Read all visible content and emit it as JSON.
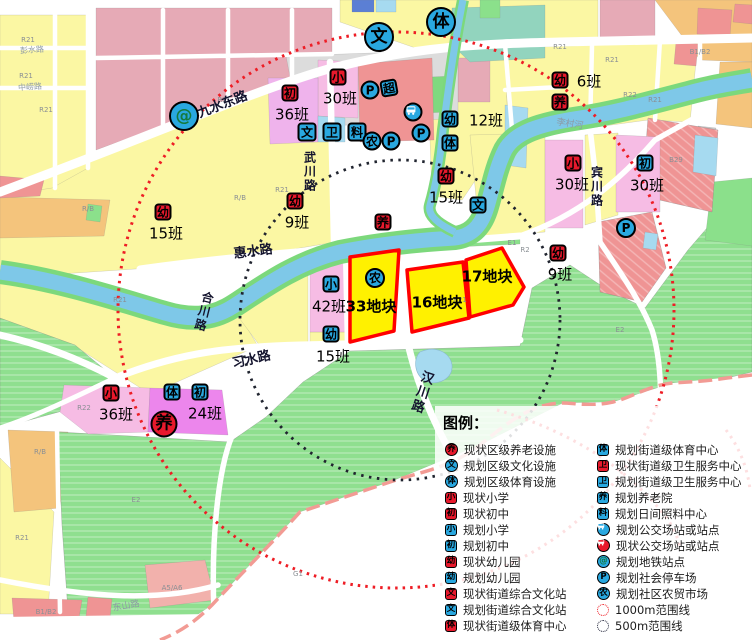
{
  "colors": {
    "icon_red": "#E8192C",
    "icon_blue": "#29A8E0",
    "metro_glyph": "#157A3E",
    "site_fill": "#FFF100",
    "site_border": "#FF0000",
    "range_1000": "#EE1D25",
    "range_500": "#23263B",
    "water": "#7EC8E8",
    "park": "#8FDF8F"
  },
  "icon_names": {
    "幼": "kindergarten",
    "小": "primary-school",
    "初": "junior-high",
    "养": "elder-care",
    "文": "culture",
    "体": "sports",
    "卫": "health-center",
    "料": "daycare",
    "农": "farmers-market",
    "P": "parking",
    "bus": "bus-stop",
    "@": "metro-station",
    "超": "supermarket"
  },
  "legend": {
    "title": "图例：",
    "left": [
      {
        "shape": "circle",
        "color": "red",
        "glyph": "养",
        "label": "现状区级养老设施"
      },
      {
        "shape": "circle",
        "color": "blue",
        "glyph": "文",
        "label": "规划区级文化设施"
      },
      {
        "shape": "circle",
        "color": "blue",
        "glyph": "体",
        "label": "规划区级体育设施"
      },
      {
        "shape": "square",
        "color": "red",
        "glyph": "小",
        "label": "现状小学"
      },
      {
        "shape": "square",
        "color": "red",
        "glyph": "初",
        "label": "现状初中"
      },
      {
        "shape": "square",
        "color": "blue",
        "glyph": "小",
        "label": "规划小学"
      },
      {
        "shape": "square",
        "color": "blue",
        "glyph": "初",
        "label": "规划初中"
      },
      {
        "shape": "square",
        "color": "red",
        "glyph": "幼",
        "label": "现状幼儿园"
      },
      {
        "shape": "square",
        "color": "blue",
        "glyph": "幼",
        "label": "规划幼儿园"
      },
      {
        "shape": "square",
        "color": "red",
        "glyph": "文",
        "label": "现状街道综合文化站"
      },
      {
        "shape": "square",
        "color": "blue",
        "glyph": "文",
        "label": "规划街道综合文化站"
      },
      {
        "shape": "square",
        "color": "red",
        "glyph": "体",
        "label": "现状街道级体育中心"
      }
    ],
    "right": [
      {
        "shape": "square",
        "color": "blue",
        "glyph": "体",
        "label": "规划街道级体育中心"
      },
      {
        "shape": "square",
        "color": "red",
        "glyph": "卫",
        "label": "现状街道级卫生服务中心"
      },
      {
        "shape": "square",
        "color": "blue",
        "glyph": "卫",
        "label": "规划街道级卫生服务中心"
      },
      {
        "shape": "square",
        "color": "blue",
        "glyph": "养",
        "label": "规划养老院"
      },
      {
        "shape": "square",
        "color": "blue",
        "glyph": "料",
        "label": "规划日间照料中心"
      },
      {
        "shape": "circle",
        "color": "blue",
        "glyph": "bus",
        "label": "规划公交场站或站点"
      },
      {
        "shape": "circle",
        "color": "red",
        "glyph": "bus",
        "label": "现状公交场站或站点"
      },
      {
        "shape": "circle",
        "color": "metro",
        "glyph": "@",
        "label": "规划地铁站点"
      },
      {
        "shape": "circle",
        "color": "blue",
        "glyph": "P",
        "label": "规划社会停车场"
      },
      {
        "shape": "circle",
        "color": "blue",
        "glyph": "农",
        "label": "规划社区农贸市场"
      },
      {
        "shape": "ring",
        "color": "red1000",
        "glyph": "",
        "label": "1000m范围线"
      },
      {
        "shape": "ring",
        "color": "navy500",
        "glyph": "",
        "label": "500m范围线"
      }
    ]
  },
  "map": {
    "plots": [
      {
        "label": "33地块",
        "x": 371,
        "y": 306
      },
      {
        "label": "16地块",
        "x": 437,
        "y": 302
      },
      {
        "label": "17地块",
        "x": 487,
        "y": 276
      }
    ],
    "markers": [
      {
        "t": "c",
        "c": "blue",
        "g": "文",
        "x": 379,
        "y": 37,
        "s": 30
      },
      {
        "t": "c",
        "c": "blue",
        "g": "体",
        "x": 441,
        "y": 22,
        "s": 30
      },
      {
        "t": "c",
        "c": "metro",
        "g": "@",
        "x": 184,
        "y": 116,
        "s": 30
      },
      {
        "t": "s",
        "c": "red",
        "g": "初",
        "x": 290,
        "y": 93,
        "label": "36班",
        "lx": 292,
        "ly": 114
      },
      {
        "t": "s",
        "c": "red",
        "g": "小",
        "x": 338,
        "y": 77,
        "label": "30班",
        "lx": 340,
        "ly": 98
      },
      {
        "t": "c",
        "c": "blue",
        "g": "P",
        "x": 370,
        "y": 90,
        "s": 19
      },
      {
        "t": "s",
        "c": "blue",
        "g": "超",
        "x": 389,
        "y": 88,
        "rot": -10
      },
      {
        "t": "s",
        "c": "blue",
        "g": "文",
        "x": 307,
        "y": 132,
        "s": 19
      },
      {
        "t": "s",
        "c": "blue",
        "g": "卫",
        "x": 332,
        "y": 132,
        "s": 19
      },
      {
        "t": "s",
        "c": "blue",
        "g": "料",
        "x": 357,
        "y": 132,
        "s": 19
      },
      {
        "t": "c",
        "c": "blue",
        "g": "农",
        "x": 372,
        "y": 141,
        "s": 19
      },
      {
        "t": "c",
        "c": "blue",
        "g": "P",
        "x": 391,
        "y": 141,
        "s": 19
      },
      {
        "t": "c",
        "c": "blue",
        "g": "bus",
        "x": 413,
        "y": 112,
        "s": 19
      },
      {
        "t": "c",
        "c": "blue",
        "g": "P",
        "x": 421,
        "y": 133,
        "s": 19
      },
      {
        "t": "s",
        "c": "blue",
        "g": "幼",
        "x": 450,
        "y": 119,
        "label": "12班",
        "lx": 486,
        "ly": 120
      },
      {
        "t": "s",
        "c": "blue",
        "g": "体",
        "x": 450,
        "y": 143
      },
      {
        "t": "s",
        "c": "red",
        "g": "幼",
        "x": 560,
        "y": 80,
        "label": "6班",
        "lx": 589,
        "ly": 81
      },
      {
        "t": "s",
        "c": "red",
        "g": "养",
        "x": 560,
        "y": 102
      },
      {
        "t": "s",
        "c": "red",
        "g": "幼",
        "x": 446,
        "y": 176,
        "label": "15班",
        "lx": 446,
        "ly": 197
      },
      {
        "t": "s",
        "c": "blue",
        "g": "文",
        "x": 478,
        "y": 205
      },
      {
        "t": "s",
        "c": "red",
        "g": "小",
        "x": 573,
        "y": 163,
        "label": "30班",
        "lx": 572,
        "ly": 184
      },
      {
        "t": "s",
        "c": "blue",
        "g": "初",
        "x": 645,
        "y": 163,
        "label": "30班",
        "lx": 647,
        "ly": 185
      },
      {
        "t": "c",
        "c": "blue",
        "g": "P",
        "x": 626,
        "y": 228,
        "s": 20
      },
      {
        "t": "s",
        "c": "red",
        "g": "幼",
        "x": 558,
        "y": 253,
        "label": "9班",
        "lx": 560,
        "ly": 274
      },
      {
        "t": "s",
        "c": "red",
        "g": "幼",
        "x": 163,
        "y": 212,
        "label": "15班",
        "lx": 166,
        "ly": 233
      },
      {
        "t": "s",
        "c": "red",
        "g": "幼",
        "x": 295,
        "y": 201,
        "label": "9班",
        "lx": 297,
        "ly": 222
      },
      {
        "t": "s",
        "c": "red",
        "g": "养",
        "x": 383,
        "y": 222
      },
      {
        "t": "s",
        "c": "blue",
        "g": "小",
        "x": 331,
        "y": 284,
        "label": "42班",
        "lx": 329,
        "ly": 306
      },
      {
        "t": "c",
        "c": "blue",
        "g": "农",
        "x": 375,
        "y": 278,
        "s": 20
      },
      {
        "t": "s",
        "c": "blue",
        "g": "幼",
        "x": 331,
        "y": 334,
        "label": "15班",
        "lx": 333,
        "ly": 356
      },
      {
        "t": "s",
        "c": "red",
        "g": "小",
        "x": 111,
        "y": 393,
        "label": "36班",
        "lx": 116,
        "ly": 414
      },
      {
        "t": "s",
        "c": "blue",
        "g": "体",
        "x": 172,
        "y": 392
      },
      {
        "t": "s",
        "c": "blue",
        "g": "初",
        "x": 200,
        "y": 392,
        "label": "24班",
        "lx": 205,
        "ly": 413
      },
      {
        "t": "c",
        "c": "red",
        "g": "养",
        "x": 164,
        "y": 424,
        "s": 27
      }
    ],
    "roadLabels": [
      {
        "text": "九水东路",
        "x": 222,
        "y": 103,
        "rot": -21,
        "size": 13
      },
      {
        "text": "武川路",
        "x": 310,
        "y": 172,
        "size": 12,
        "vertical": true
      },
      {
        "text": "惠水路",
        "x": 253,
        "y": 250,
        "rot": -7,
        "size": 13
      },
      {
        "text": "合川路",
        "x": 204,
        "y": 312,
        "size": 12,
        "vertical": true,
        "rot": 14
      },
      {
        "text": "习水路",
        "x": 251,
        "y": 358,
        "rot": -13,
        "size": 13
      },
      {
        "text": "汉川路",
        "x": 421,
        "y": 392,
        "size": 13,
        "vertical": true,
        "rot": 18
      },
      {
        "text": "宾川路",
        "x": 597,
        "y": 187,
        "size": 12,
        "vertical": true
      },
      {
        "text": "李村河",
        "x": 570,
        "y": 123,
        "rot": 9,
        "size": 9,
        "faint": true
      },
      {
        "text": "彭水路",
        "x": 32,
        "y": 50,
        "rot": -4,
        "size": 8,
        "faint": true
      },
      {
        "text": "中崂路",
        "x": 30,
        "y": 87,
        "rot": -4,
        "size": 8,
        "faint": true
      },
      {
        "text": "东山路",
        "x": 126,
        "y": 605,
        "rot": -10,
        "size": 9,
        "faint": true
      }
    ],
    "parcelCodes": [
      {
        "t": "R21",
        "x": 28,
        "y": 40
      },
      {
        "t": "R21",
        "x": 26,
        "y": 76
      },
      {
        "t": "R21",
        "x": 46,
        "y": 110
      },
      {
        "t": "R2",
        "x": 222,
        "y": 100
      },
      {
        "t": "R/B",
        "x": 88,
        "y": 209
      },
      {
        "t": "R/B",
        "x": 240,
        "y": 198
      },
      {
        "t": "R21",
        "x": 282,
        "y": 190
      },
      {
        "t": "R21",
        "x": 120,
        "y": 300
      },
      {
        "t": "R21",
        "x": 460,
        "y": 300
      },
      {
        "t": "R22",
        "x": 84,
        "y": 408
      },
      {
        "t": "R21",
        "x": 560,
        "y": 47
      },
      {
        "t": "R21",
        "x": 612,
        "y": 60
      },
      {
        "t": "R22",
        "x": 630,
        "y": 95
      },
      {
        "t": "R21",
        "x": 655,
        "y": 100
      },
      {
        "t": "B1/B2",
        "x": 700,
        "y": 52
      },
      {
        "t": "B29",
        "x": 676,
        "y": 160
      },
      {
        "t": "R2",
        "x": 525,
        "y": 250
      },
      {
        "t": "E1",
        "x": 512,
        "y": 243
      },
      {
        "t": "R21",
        "x": 22,
        "y": 538
      },
      {
        "t": "R/B",
        "x": 40,
        "y": 452
      },
      {
        "t": "A5/A6",
        "x": 172,
        "y": 588
      },
      {
        "t": "B1/B2",
        "x": 46,
        "y": 612
      },
      {
        "t": "E2",
        "x": 136,
        "y": 500
      },
      {
        "t": "E2",
        "x": 620,
        "y": 330
      },
      {
        "t": "G1",
        "x": 298,
        "y": 574
      }
    ]
  }
}
